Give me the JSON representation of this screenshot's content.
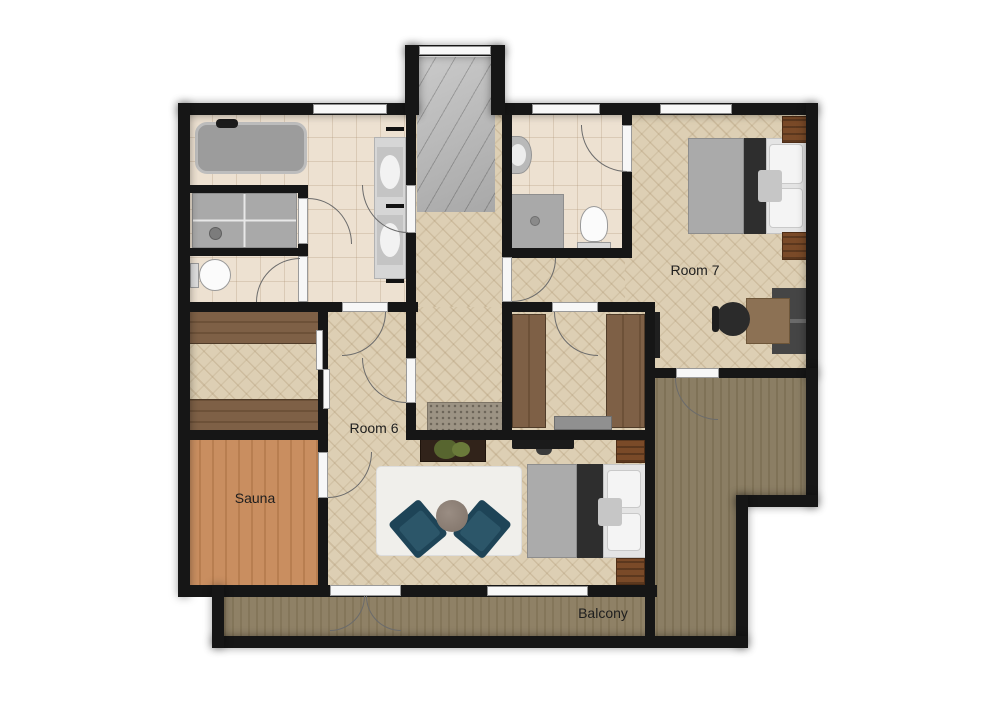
{
  "floorplan": {
    "rooms": {
      "room7": {
        "label": "Room 7"
      },
      "room6": {
        "label": "Room 6"
      },
      "sauna": {
        "label": "Sauna"
      },
      "balcony": {
        "label": "Balcony"
      }
    },
    "colors": {
      "wall": "#161616",
      "herringbone_floor": "#ddcfb4",
      "bathroom_tile": "#ede1d1",
      "sauna_wood": "#c98e60",
      "balcony_deck": "#8f8166",
      "terrace_deck": "#8b7e64",
      "stairs_gray": "#b9b9b9",
      "armchair_teal": "#1e4457",
      "nightstand_brown": "#7a4a28",
      "bed_blanket_gray": "#aaaaaa",
      "bed_band_dark": "#2e2e2e",
      "door_white": "#f7f7f7"
    },
    "fixtures": [
      "bathtub",
      "shower-enclosure",
      "toilet",
      "double-vanity",
      "staircase",
      "shower",
      "toilet-2",
      "sink",
      "double-bed",
      "nightstand",
      "desk",
      "office-chair",
      "dresser",
      "wall-tv",
      "walk-in-wardrobe",
      "closet-bench",
      "wardrobe-band",
      "sideboard",
      "plant",
      "tv-stand",
      "area-rug",
      "armchair",
      "coffee-table",
      "double-bed-2",
      "hall-mat",
      "french-door",
      "window"
    ]
  }
}
